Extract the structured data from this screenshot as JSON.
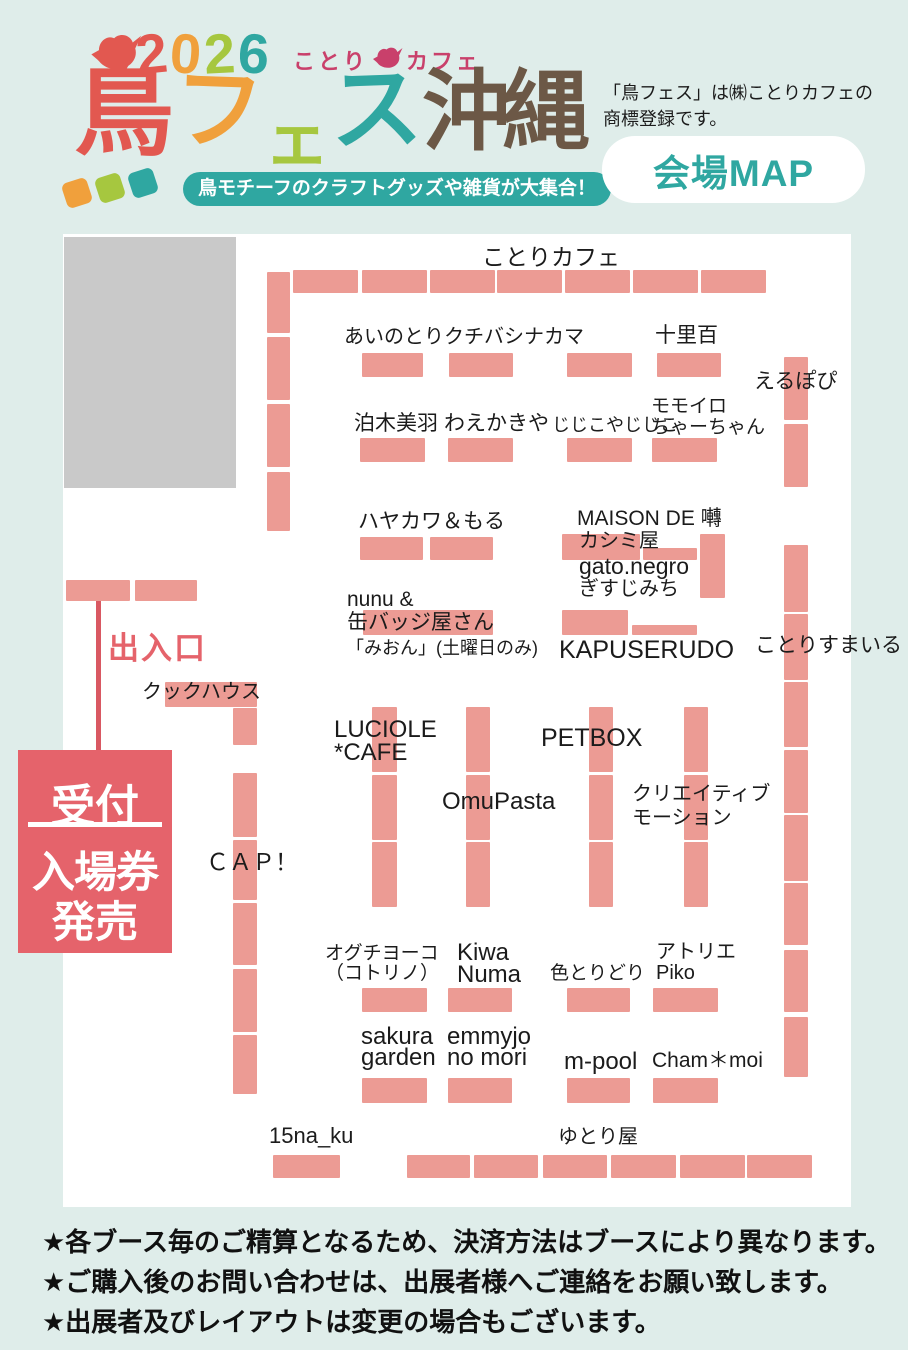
{
  "colors": {
    "background": "#dfedea",
    "map_background": "#ffffff",
    "booth": "#EC9B94",
    "accent_red": "#E5636B",
    "teal": "#2FA7A1",
    "orange": "#F0A03C",
    "green": "#A6C73F",
    "logo_red": "#E25850",
    "brown": "#6C5846",
    "magenta": "#C9406B",
    "gray_area": "#c9c9c9"
  },
  "header": {
    "year_digits": [
      {
        "t": "2",
        "c": "#E25850"
      },
      {
        "t": "0",
        "c": "#F0A03C"
      },
      {
        "t": "2",
        "c": "#A6C73F"
      },
      {
        "t": "6",
        "c": "#2FA7A1"
      }
    ],
    "wordmark_pre": "ことり",
    "wordmark_post": "カフェ",
    "title_chars": [
      {
        "t": "鳥",
        "c": "#E25850"
      },
      {
        "t": "フ",
        "c": "#F0A03C"
      },
      {
        "t": "ェ",
        "c": "#A6C73F"
      },
      {
        "t": "ス",
        "c": "#2FA7A1"
      },
      {
        "t": "沖縄",
        "c": "#6C5846"
      }
    ],
    "decor_diamonds": [
      "#F0A03C",
      "#A6C73F",
      "#2FA7A1"
    ],
    "tagline": "鳥モチーフのクラフトグッズや雑貨が大集合！",
    "trademark_lines": [
      "「鳥フェス」は㈱ことりカフェの",
      "商標登録です。"
    ],
    "map_button": "会場MAP"
  },
  "map": {
    "entrance": {
      "label": "出入口",
      "bars": [
        [
          66,
          580,
          64,
          21
        ],
        [
          135,
          580,
          62,
          21
        ]
      ],
      "line": [
        96,
        601,
        5,
        149
      ]
    },
    "reception": {
      "line1": "受付",
      "line2": "入場券",
      "line3": "発売"
    },
    "labels": [
      {
        "id": "kotori-cafe",
        "lines": [
          "ことりカフェ"
        ],
        "x": 482,
        "y": 244,
        "fs": 23
      },
      {
        "id": "ainotori-kuchibashinakama",
        "lines": [
          "あいのとりクチバシナカマ"
        ],
        "x": 344,
        "y": 326,
        "fs": 20
      },
      {
        "id": "jurihyaku",
        "lines": [
          "十里百"
        ],
        "x": 655,
        "y": 324,
        "fs": 21
      },
      {
        "id": "erupopi",
        "lines": [
          "えるぽぴ"
        ],
        "x": 754,
        "y": 370,
        "fs": 21
      },
      {
        "id": "tomarigi-miu",
        "lines": [
          "泊木美羽"
        ],
        "x": 354,
        "y": 412,
        "fs": 21
      },
      {
        "id": "waekakiya",
        "lines": [
          "わえかきや"
        ],
        "x": 444,
        "y": 412,
        "fs": 21
      },
      {
        "id": "jijikoyajijiko",
        "lines": [
          "じじこやじじこ"
        ],
        "x": 552,
        "y": 415,
        "fs": 18
      },
      {
        "id": "momoiro-chaachan",
        "lines": [
          "モモイロ",
          "ちゃーちゃん"
        ],
        "x": 651,
        "y": 396,
        "fs": 19,
        "lh": 21
      },
      {
        "id": "hayakawa-moru",
        "lines": [
          "ハヤカワ＆もる"
        ],
        "x": 358,
        "y": 510,
        "fs": 21
      },
      {
        "id": "maison-de-saezuri",
        "lines": [
          "MAISON DE 囀"
        ],
        "x": 577,
        "y": 507,
        "fs": 21
      },
      {
        "id": "kashimiya",
        "lines": [
          "カシミ屋"
        ],
        "x": 579,
        "y": 530,
        "fs": 20
      },
      {
        "id": "gato-negro",
        "lines": [
          "gato.negro"
        ],
        "x": 579,
        "y": 553,
        "fs": 23
      },
      {
        "id": "gisujimichi",
        "lines": [
          "ぎすじみち"
        ],
        "x": 579,
        "y": 578,
        "fs": 20
      },
      {
        "id": "nunu-kanbadge",
        "lines": [
          "nunu &",
          "缶バッジ屋さん"
        ],
        "x": 347,
        "y": 588,
        "fs": 21,
        "lh": 23
      },
      {
        "id": "mion-saturday-only",
        "lines": [
          "「みおん」(土曜日のみ)"
        ],
        "x": 346,
        "y": 638,
        "fs": 18
      },
      {
        "id": "kapuserudo",
        "lines": [
          "KAPUSERUDO"
        ],
        "x": 559,
        "y": 636,
        "fs": 25
      },
      {
        "id": "kotorisumairu",
        "lines": [
          "ことりすまいる"
        ],
        "x": 755,
        "y": 634,
        "fs": 21
      },
      {
        "id": "kukku-house",
        "lines": [
          "クックハウス"
        ],
        "x": 142,
        "y": 681,
        "fs": 20
      },
      {
        "id": "luciole-cafe",
        "lines": [
          "LUCIOLE",
          "*CAFE"
        ],
        "x": 334,
        "y": 718,
        "fs": 24,
        "lh": 23
      },
      {
        "id": "petbox",
        "lines": [
          "PETBOX"
        ],
        "x": 541,
        "y": 724,
        "fs": 25
      },
      {
        "id": "omupasta",
        "lines": [
          "OmuPasta"
        ],
        "x": 442,
        "y": 788,
        "fs": 24
      },
      {
        "id": "creative-motion",
        "lines": [
          "クリエイティブ",
          "モーション"
        ],
        "x": 632,
        "y": 782,
        "fs": 20,
        "lh": 24
      },
      {
        "id": "cap",
        "lines": [
          "ＣＡＰ！"
        ],
        "x": 206,
        "y": 849,
        "fs": 23
      },
      {
        "id": "oguchi-yoko-kotorino",
        "lines": [
          "オグチヨーコ",
          "（コトリノ）"
        ],
        "x": 325,
        "y": 944,
        "fs": 19,
        "lh": 20
      },
      {
        "id": "kiwa-numa",
        "lines": [
          "Kiwa",
          "Numa"
        ],
        "x": 457,
        "y": 942,
        "fs": 24,
        "lh": 22
      },
      {
        "id": "irotoridori",
        "lines": [
          "色とりどり"
        ],
        "x": 550,
        "y": 963,
        "fs": 19
      },
      {
        "id": "atelier-piko",
        "lines": [
          "アトリエ",
          "Piko"
        ],
        "x": 656,
        "y": 942,
        "fs": 20,
        "lh": 21
      },
      {
        "id": "sakura-garden",
        "lines": [
          "sakura",
          "garden"
        ],
        "x": 361,
        "y": 1026,
        "fs": 24,
        "lh": 21
      },
      {
        "id": "emmyjo-no-mori",
        "lines": [
          "emmyjo",
          "no mori"
        ],
        "x": 447,
        "y": 1026,
        "fs": 24,
        "lh": 21
      },
      {
        "id": "m-pool",
        "lines": [
          "m-pool"
        ],
        "x": 564,
        "y": 1048,
        "fs": 24
      },
      {
        "id": "cham-moi",
        "lines": [
          "Cham＊moi"
        ],
        "x": 652,
        "y": 1049,
        "fs": 21
      },
      {
        "id": "15na-ku",
        "lines": [
          "15na_ku"
        ],
        "x": 269,
        "y": 1123,
        "fs": 22
      },
      {
        "id": "yutoriya",
        "lines": [
          "ゆとり屋"
        ],
        "x": 558,
        "y": 1126,
        "fs": 20
      }
    ],
    "booths": [
      [
        267,
        272,
        23,
        61
      ],
      [
        267,
        337,
        23,
        63
      ],
      [
        267,
        404,
        23,
        63
      ],
      [
        267,
        472,
        23,
        59
      ],
      [
        293,
        270,
        65,
        23
      ],
      [
        362,
        270,
        65,
        23
      ],
      [
        430,
        270,
        65,
        23
      ],
      [
        497,
        270,
        65,
        23
      ],
      [
        565,
        270,
        65,
        23
      ],
      [
        633,
        270,
        65,
        23
      ],
      [
        701,
        270,
        65,
        23
      ],
      [
        362,
        353,
        61,
        24
      ],
      [
        449,
        353,
        64,
        24
      ],
      [
        567,
        353,
        65,
        24
      ],
      [
        657,
        353,
        64,
        24
      ],
      [
        360,
        438,
        65,
        24
      ],
      [
        448,
        438,
        65,
        24
      ],
      [
        567,
        438,
        65,
        24
      ],
      [
        652,
        438,
        65,
        24
      ],
      [
        360,
        537,
        63,
        23
      ],
      [
        430,
        537,
        63,
        23
      ],
      [
        562,
        534,
        78,
        26
      ],
      [
        643,
        548,
        54,
        12
      ],
      [
        700,
        534,
        25,
        64
      ],
      [
        363,
        610,
        130,
        25
      ],
      [
        562,
        610,
        66,
        25
      ],
      [
        632,
        625,
        65,
        10
      ],
      [
        165,
        682,
        92,
        25
      ],
      [
        233,
        708,
        24,
        37
      ],
      [
        233,
        773,
        24,
        64
      ],
      [
        233,
        840,
        24,
        60
      ],
      [
        233,
        903,
        24,
        62
      ],
      [
        233,
        969,
        24,
        63
      ],
      [
        233,
        1035,
        24,
        59
      ],
      [
        372,
        707,
        25,
        65
      ],
      [
        372,
        775,
        25,
        65
      ],
      [
        372,
        842,
        25,
        65
      ],
      [
        466,
        707,
        24,
        65
      ],
      [
        466,
        775,
        24,
        65
      ],
      [
        466,
        842,
        24,
        65
      ],
      [
        589,
        707,
        24,
        65
      ],
      [
        589,
        775,
        24,
        65
      ],
      [
        589,
        842,
        24,
        65
      ],
      [
        684,
        707,
        24,
        65
      ],
      [
        684,
        775,
        24,
        65
      ],
      [
        684,
        842,
        24,
        65
      ],
      [
        784,
        357,
        24,
        63
      ],
      [
        784,
        424,
        24,
        63
      ],
      [
        784,
        545,
        24,
        67
      ],
      [
        784,
        614,
        24,
        66
      ],
      [
        784,
        682,
        24,
        65
      ],
      [
        784,
        750,
        24,
        63
      ],
      [
        784,
        815,
        24,
        66
      ],
      [
        784,
        883,
        24,
        62
      ],
      [
        784,
        950,
        24,
        62
      ],
      [
        784,
        1017,
        24,
        60
      ],
      [
        362,
        988,
        65,
        24
      ],
      [
        448,
        988,
        64,
        24
      ],
      [
        567,
        988,
        63,
        24
      ],
      [
        653,
        988,
        65,
        24
      ],
      [
        362,
        1078,
        65,
        25
      ],
      [
        448,
        1078,
        64,
        25
      ],
      [
        567,
        1078,
        63,
        25
      ],
      [
        653,
        1078,
        65,
        25
      ],
      [
        273,
        1155,
        67,
        23
      ],
      [
        407,
        1155,
        63,
        23
      ],
      [
        474,
        1155,
        64,
        23
      ],
      [
        543,
        1155,
        64,
        23
      ],
      [
        611,
        1155,
        65,
        23
      ],
      [
        680,
        1155,
        65,
        23
      ],
      [
        747,
        1155,
        65,
        23
      ]
    ]
  },
  "footer": {
    "notes": [
      "★各ブース毎のご精算となるため、決済方法はブースにより異なります。",
      "★ご購入後のお問い合わせは、出展者様へご連絡をお願い致します。",
      "★出展者及びレイアウトは変更の場合もございます。"
    ]
  }
}
